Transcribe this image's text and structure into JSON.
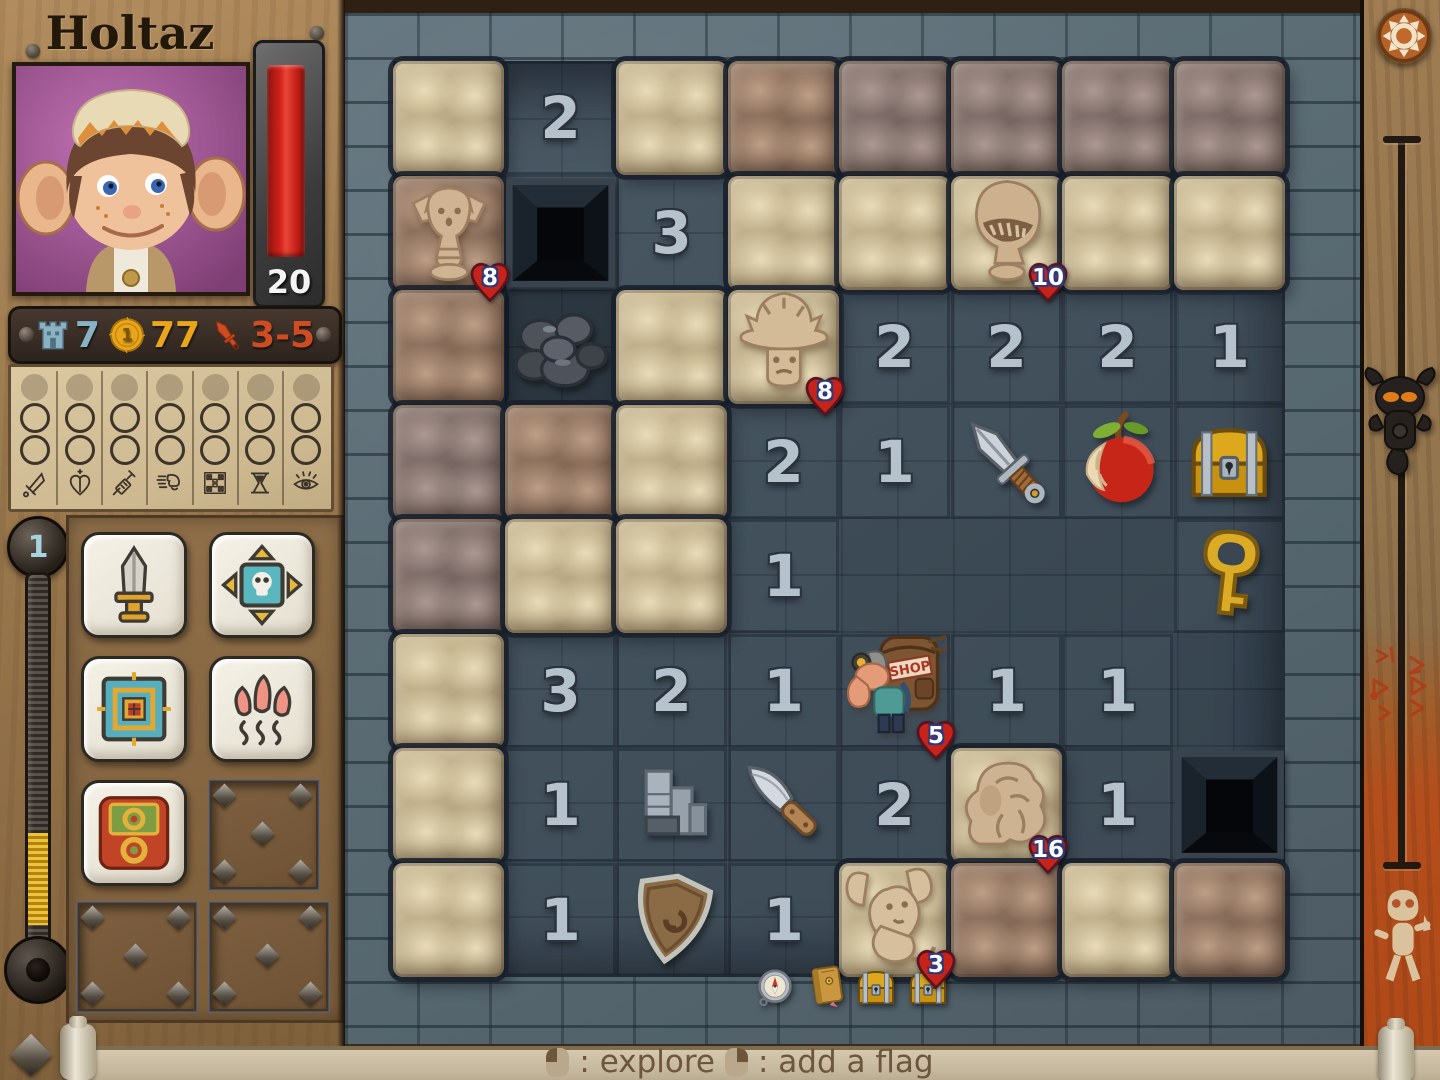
{
  "title": "Holtaz",
  "portrait": {
    "icon": "hero-portrait",
    "bg_color": "#a85a9e"
  },
  "hp": {
    "value": "20",
    "bar_color": "#c41e16"
  },
  "stats": {
    "defense": {
      "icon": "tower-icon",
      "value": "7",
      "color": "#87b3c5"
    },
    "gold": {
      "icon": "coin-icon",
      "coin_label": "1",
      "value": "77",
      "color": "#eba519"
    },
    "attack": {
      "icon": "dagger-icon",
      "value": "3-5",
      "color": "#cf4b22"
    }
  },
  "level": {
    "value": "1"
  },
  "skills": {
    "tracks": [
      {
        "icon": "attack-skill-icon",
        "glyph": "psword"
      },
      {
        "icon": "health-skill-icon",
        "glyph": "pheart"
      },
      {
        "icon": "potion-skill-icon",
        "glyph": "psyringe"
      },
      {
        "icon": "speed-skill-icon",
        "glyph": "pspeed"
      },
      {
        "icon": "trap-skill-icon",
        "glyph": "pgrid"
      },
      {
        "icon": "time-skill-icon",
        "glyph": "phourglass"
      },
      {
        "icon": "vision-skill-icon",
        "glyph": "peye"
      }
    ],
    "cards": [
      {
        "name": "sword-skill-card",
        "glyph": "cardsword"
      },
      {
        "name": "beast-compass-skill-card",
        "glyph": "cardskull"
      },
      {
        "name": "target-skill-card",
        "glyph": "cardtarget"
      },
      {
        "name": "claw-skill-card",
        "glyph": "cardclaw"
      },
      {
        "name": "relic-skill-card",
        "glyph": "cardrelic"
      }
    ]
  },
  "board": {
    "rows": 8,
    "cols": 8,
    "shop_sign": "SHOP",
    "cells": [
      [
        {
          "k": "hidden",
          "v": "beige"
        },
        {
          "k": "num",
          "n": "2"
        },
        {
          "k": "hidden",
          "v": "beige"
        },
        {
          "k": "hidden",
          "v": "brown"
        },
        {
          "k": "hidden",
          "v": "mauve"
        },
        {
          "k": "hidden",
          "v": "mauve"
        },
        {
          "k": "hidden",
          "v": "mauve"
        },
        {
          "k": "hidden",
          "v": "mauve"
        }
      ],
      [
        {
          "k": "monster",
          "m": "statue",
          "hp": "8",
          "bg": "brown"
        },
        {
          "k": "pit"
        },
        {
          "k": "num",
          "n": "3"
        },
        {
          "k": "hidden",
          "v": "beige"
        },
        {
          "k": "hidden",
          "v": "beige"
        },
        {
          "k": "monster",
          "m": "helm",
          "hp": "10",
          "bg": "beige"
        },
        {
          "k": "hidden",
          "v": "beige"
        },
        {
          "k": "hidden",
          "v": "beige"
        }
      ],
      [
        {
          "k": "hidden",
          "v": "brown"
        },
        {
          "k": "rocks"
        },
        {
          "k": "hidden",
          "v": "beige"
        },
        {
          "k": "monster",
          "m": "mush",
          "hp": "8",
          "bg": "beige"
        },
        {
          "k": "num",
          "n": "2"
        },
        {
          "k": "num",
          "n": "2"
        },
        {
          "k": "num",
          "n": "2"
        },
        {
          "k": "num",
          "n": "1"
        }
      ],
      [
        {
          "k": "hidden",
          "v": "mauve"
        },
        {
          "k": "hidden",
          "v": "brown"
        },
        {
          "k": "hidden",
          "v": "beige"
        },
        {
          "k": "num",
          "n": "2"
        },
        {
          "k": "num",
          "n": "1"
        },
        {
          "k": "item",
          "item": "dagger"
        },
        {
          "k": "item",
          "item": "apple"
        },
        {
          "k": "item",
          "item": "chest"
        }
      ],
      [
        {
          "k": "hidden",
          "v": "mauve"
        },
        {
          "k": "hidden",
          "v": "beige"
        },
        {
          "k": "hidden",
          "v": "beige"
        },
        {
          "k": "num",
          "n": "1"
        },
        {
          "k": "empty"
        },
        {
          "k": "empty"
        },
        {
          "k": "empty"
        },
        {
          "k": "item",
          "item": "key"
        }
      ],
      [
        {
          "k": "hidden",
          "v": "beige"
        },
        {
          "k": "num",
          "n": "3"
        },
        {
          "k": "num",
          "n": "2"
        },
        {
          "k": "num",
          "n": "1"
        },
        {
          "k": "monster",
          "m": "shop",
          "hp": "5",
          "bg": "floor"
        },
        {
          "k": "num",
          "n": "1"
        },
        {
          "k": "num",
          "n": "1"
        },
        {
          "k": "empty"
        }
      ],
      [
        {
          "k": "hidden",
          "v": "beige"
        },
        {
          "k": "num",
          "n": "1"
        },
        {
          "k": "item",
          "item": "stairs"
        },
        {
          "k": "item",
          "item": "knife"
        },
        {
          "k": "num",
          "n": "2"
        },
        {
          "k": "monster",
          "m": "troll",
          "hp": "16",
          "bg": "beige"
        },
        {
          "k": "num",
          "n": "1"
        },
        {
          "k": "pit"
        }
      ],
      [
        {
          "k": "hidden",
          "v": "beige"
        },
        {
          "k": "num",
          "n": "1"
        },
        {
          "k": "item",
          "item": "shield"
        },
        {
          "k": "num",
          "n": "1"
        },
        {
          "k": "monster",
          "m": "rat",
          "hp": "3",
          "bg": "beige"
        },
        {
          "k": "hidden",
          "v": "brown"
        },
        {
          "k": "hidden",
          "v": "beige"
        },
        {
          "k": "hidden",
          "v": "brown"
        }
      ]
    ],
    "bottom_loot": [
      {
        "item": "compass",
        "x": 408,
        "y": 966,
        "s": 44
      },
      {
        "item": "book",
        "x": 458,
        "y": 962,
        "s": 48
      },
      {
        "item": "chest",
        "x": 506,
        "y": 962,
        "s": 50
      },
      {
        "item": "chest",
        "x": 558,
        "y": 962,
        "s": 50
      }
    ]
  },
  "footer": {
    "explore": ": explore",
    "add_flag": ": add a flag",
    "left_mouse_icon": "left-mouse-icon",
    "right_mouse_icon": "right-mouse-icon"
  },
  "colors": {
    "wood": "#9c794e",
    "wall": "#5c6d7a",
    "floor": "#3c4a55",
    "hp_red": "#c41e16",
    "badge_red": "#c6231a",
    "accent_orange": "#b44e1c"
  }
}
